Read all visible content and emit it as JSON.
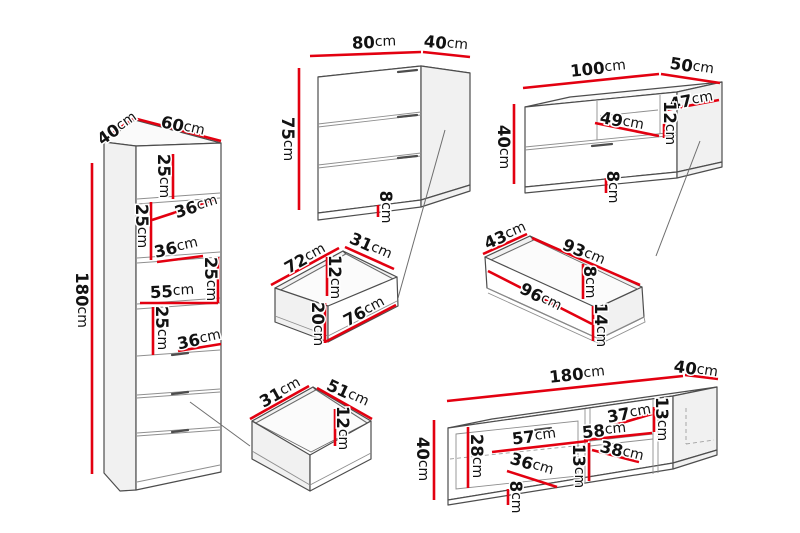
{
  "diagram": {
    "unit": "cm",
    "background": "#ffffff",
    "dimension_line_color": "#e30010",
    "outline_color": "#4d4d4d",
    "label_color": "#121212"
  },
  "pieces": [
    {
      "id": "tall-cabinet",
      "labels": [
        {
          "v": "40",
          "x": 117,
          "y": 128,
          "r": -35
        },
        {
          "v": "60",
          "x": 183,
          "y": 126,
          "r": 13
        },
        {
          "v": "180",
          "x": 82,
          "y": 300,
          "r": 90
        },
        {
          "v": "25",
          "x": 164,
          "y": 176,
          "r": 90
        },
        {
          "v": "36",
          "x": 196,
          "y": 206,
          "r": -17
        },
        {
          "v": "25",
          "x": 142,
          "y": 226,
          "r": 90
        },
        {
          "v": "36",
          "x": 176,
          "y": 247,
          "r": -13
        },
        {
          "v": "25",
          "x": 211,
          "y": 279,
          "r": 90
        },
        {
          "v": "55",
          "x": 172,
          "y": 291,
          "r": -3
        },
        {
          "v": "25",
          "x": 162,
          "y": 328,
          "r": 90
        },
        {
          "v": "36",
          "x": 199,
          "y": 339,
          "r": -12
        }
      ]
    },
    {
      "id": "chest-of-drawers",
      "labels": [
        {
          "v": "80",
          "x": 374,
          "y": 42,
          "r": -2
        },
        {
          "v": "40",
          "x": 446,
          "y": 43,
          "r": 6
        },
        {
          "v": "75",
          "x": 288,
          "y": 139,
          "r": 90
        },
        {
          "v": "8",
          "x": 386,
          "y": 207,
          "r": 90
        }
      ]
    },
    {
      "id": "tv-bench",
      "labels": [
        {
          "v": "100",
          "x": 598,
          "y": 68,
          "r": -6
        },
        {
          "v": "50",
          "x": 692,
          "y": 66,
          "r": 9
        },
        {
          "v": "40",
          "x": 504,
          "y": 147,
          "r": 90
        },
        {
          "v": "49",
          "x": 622,
          "y": 121,
          "r": 11
        },
        {
          "v": "47",
          "x": 691,
          "y": 100,
          "r": -10
        },
        {
          "v": "12",
          "x": 670,
          "y": 123,
          "r": 90
        },
        {
          "v": "8",
          "x": 613,
          "y": 187,
          "r": 90
        }
      ]
    },
    {
      "id": "drawer-72x31",
      "labels": [
        {
          "v": "72",
          "x": 305,
          "y": 258,
          "r": -29
        },
        {
          "v": "31",
          "x": 371,
          "y": 246,
          "r": 24
        },
        {
          "v": "12",
          "x": 335,
          "y": 277,
          "r": 90
        },
        {
          "v": "76",
          "x": 364,
          "y": 311,
          "r": -28
        },
        {
          "v": "20",
          "x": 318,
          "y": 324,
          "r": 90
        }
      ]
    },
    {
      "id": "drawer-93x43",
      "labels": [
        {
          "v": "43",
          "x": 505,
          "y": 235,
          "r": -24
        },
        {
          "v": "93",
          "x": 584,
          "y": 252,
          "r": 23
        },
        {
          "v": "96",
          "x": 541,
          "y": 297,
          "r": 27
        },
        {
          "v": "8",
          "x": 590,
          "y": 282,
          "r": 90
        },
        {
          "v": "14",
          "x": 601,
          "y": 325,
          "r": 90
        }
      ]
    },
    {
      "id": "drawer-51x31",
      "labels": [
        {
          "v": "31",
          "x": 280,
          "y": 392,
          "r": -29
        },
        {
          "v": "51",
          "x": 348,
          "y": 393,
          "r": 25
        },
        {
          "v": "12",
          "x": 343,
          "y": 428,
          "r": 90
        }
      ]
    },
    {
      "id": "tv-stand-180",
      "labels": [
        {
          "v": "180",
          "x": 577,
          "y": 374,
          "r": -6
        },
        {
          "v": "40",
          "x": 696,
          "y": 369,
          "r": 9
        },
        {
          "v": "40",
          "x": 423,
          "y": 459,
          "r": 90
        },
        {
          "v": "28",
          "x": 477,
          "y": 456,
          "r": 90
        },
        {
          "v": "57",
          "x": 534,
          "y": 436,
          "r": -7
        },
        {
          "v": "58",
          "x": 604,
          "y": 430,
          "r": -6
        },
        {
          "v": "37",
          "x": 629,
          "y": 413,
          "r": -10
        },
        {
          "v": "13",
          "x": 662,
          "y": 419,
          "r": 90
        },
        {
          "v": "38",
          "x": 622,
          "y": 451,
          "r": 14
        },
        {
          "v": "13",
          "x": 579,
          "y": 466,
          "r": 90
        },
        {
          "v": "36",
          "x": 532,
          "y": 464,
          "r": 17
        },
        {
          "v": "8",
          "x": 516,
          "y": 497,
          "r": 90
        }
      ]
    }
  ]
}
